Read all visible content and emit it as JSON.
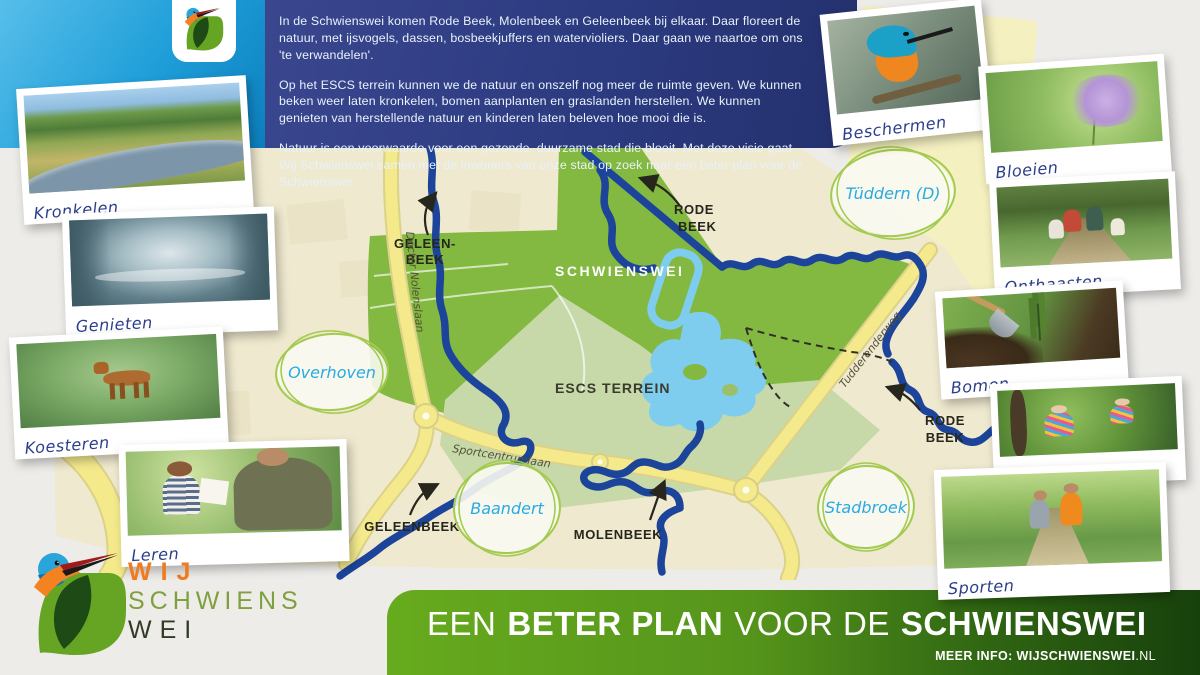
{
  "intro": {
    "p1": "In de Schwienswei komen Rode Beek, Molenbeek en Geleenbeek bij elkaar. Daar floreert de natuur, met ijsvogels, dassen, bosbeekjuffers en watervioliers. Daar gaan we naartoe om ons 'te verwandelen'.",
    "p2": "Op het ESCS terrein kunnen we de natuur en onszelf nog meer de ruimte geven. We kunnen beken weer laten kronkelen, bomen aanplanten en graslanden herstellen. We kunnen genieten van herstellende natuur en kinderen laten beleven hoe mooi die is.",
    "p3": "Natuur is een voorwaarde voor een gezonde, duurzame stad die bloeit. Met deze visie gaat Wij Schwienswei samen met de inwoners van onze stad op zoek naar een beter plan voor de Schwienswei."
  },
  "photos": {
    "kronkelen": "Kronkelen",
    "genieten": "Genieten",
    "koesteren": "Koesteren",
    "leren": "Leren",
    "beschermen": "Beschermen",
    "bloeien": "Bloeien",
    "onthaasten": "Onthaasten",
    "bomen": "Bomen",
    "spelen": "spelen",
    "sporten": "Sporten"
  },
  "map": {
    "area_schwienswei": "SCHWIENSWEI",
    "area_escs": "ESCS TERREIN",
    "geleenbeek_top_l1": "GELEEN-",
    "geleenbeek_top_l2": "BEEK",
    "rodebeek_top_l1": "RODE",
    "rodebeek_top_l2": "BEEK",
    "geleenbeek_bottom": "GELEENBEEK",
    "molenbeek": "MOLENBEEK",
    "rodebeek_right_l1": "RODE",
    "rodebeek_right_l2": "BEEK",
    "road_nolenslaan": "Docter Nolenslaan",
    "road_sportcentrumlaan": "Sportcentrumlaan",
    "road_tudderenderweg": "Tudderenderweg",
    "place_tuddern": "Tüddern (D)",
    "place_overhoven": "Overhoven",
    "place_baandert": "Baandert",
    "place_stadbroek": "Stadbroek"
  },
  "logo": {
    "word1": "WIJ",
    "word2": "SCHWIENS",
    "word3": "WEI"
  },
  "banner": {
    "t1": "EEN",
    "t2": "BETER PLAN",
    "t3": "VOOR DE",
    "t4": "SCHWIENSWEI",
    "info_label": "MEER INFO:",
    "info_domain": "WIJSCHWIENSWEI",
    "info_tld": ".NL"
  },
  "colors": {
    "header_blue": "#1E9ED8",
    "panel_navy": "#2C3A80",
    "map_green": "#83B841",
    "map_sage": "#C7D9A9",
    "pond_blue": "#7FCDEE",
    "stream_navy": "#1B449A",
    "road_yellow": "#F4EA8C",
    "banner_green": "#55941B",
    "label_navy": "#2B3E8C",
    "place_cyan": "#29ABE2",
    "logo_orange": "#F07A1F",
    "logo_olive": "#7FA03C"
  }
}
